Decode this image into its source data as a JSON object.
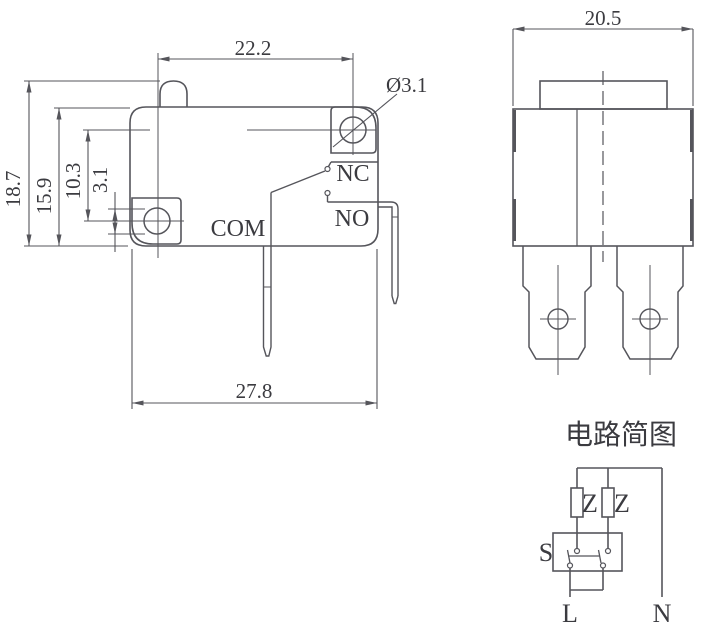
{
  "meta": {
    "drawing_type": "micro switch dimension drawing",
    "background_color": "#ffffff",
    "line_color": "#55555b",
    "text_color": "#3b3b40"
  },
  "front_view": {
    "dims": {
      "hole_pitch_h": "22.2",
      "total_width": "27.8",
      "total_height": "18.7",
      "body_height": "15.9",
      "hole_pitch_v": "10.3",
      "hole_size": "3.1",
      "hole_diameter": "Ø3.1"
    },
    "labels": {
      "com": "COM",
      "nc": "NC",
      "no": "NO"
    }
  },
  "side_view": {
    "dims": {
      "width": "20.5"
    }
  },
  "circuit": {
    "title": "电路简图",
    "labels": {
      "z1": "Z",
      "z2": "Z",
      "s": "S",
      "l": "L",
      "n": "N"
    }
  }
}
